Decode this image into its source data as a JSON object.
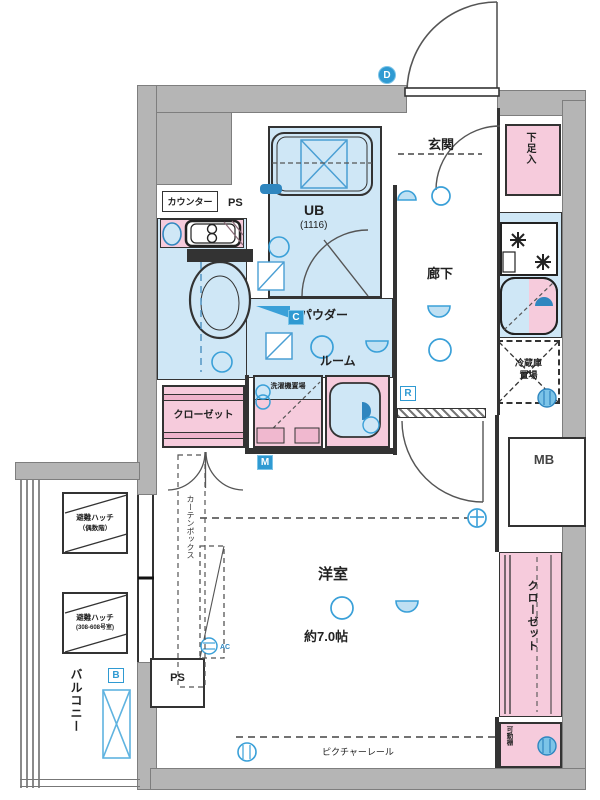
{
  "labels": {
    "counter": "カウンター",
    "ps_top": "PS",
    "genkan": "玄関",
    "shoe_box": "下足入",
    "ub": "UB",
    "ub_size": "(1116)",
    "hallway": "廊下",
    "powder_l1": "パウダー",
    "powder_l2": "ルーム",
    "laundry": "洗濯機置場",
    "fridge_l1": "冷蔵庫",
    "fridge_l2": "置場",
    "mb": "MB",
    "closet_left": "クローゼット",
    "closet_right": "クローゼット",
    "shelf": "可動棚",
    "room": "洋室",
    "room_size": "約7.0帖",
    "curtain": "カーテンボックス",
    "ps_bottom": "PS",
    "rail": "ピクチャーレール",
    "balcony": "バルコニー",
    "hatch1_l1": "避難ハッチ",
    "hatch1_l2": "（偶数階）",
    "hatch2_l1": "避難ハッチ",
    "hatch2_l2": "(308-608号室)",
    "ac": "AC"
  },
  "markers": {
    "d": "D",
    "c": "C",
    "m": "M",
    "r": "R",
    "b": "B"
  },
  "colors": {
    "wall": "#b5b5b5",
    "room_blue": "#cfe7f6",
    "pink": "#f6cbdc",
    "accent_blue": "#3aa0d8",
    "line": "#333333"
  }
}
